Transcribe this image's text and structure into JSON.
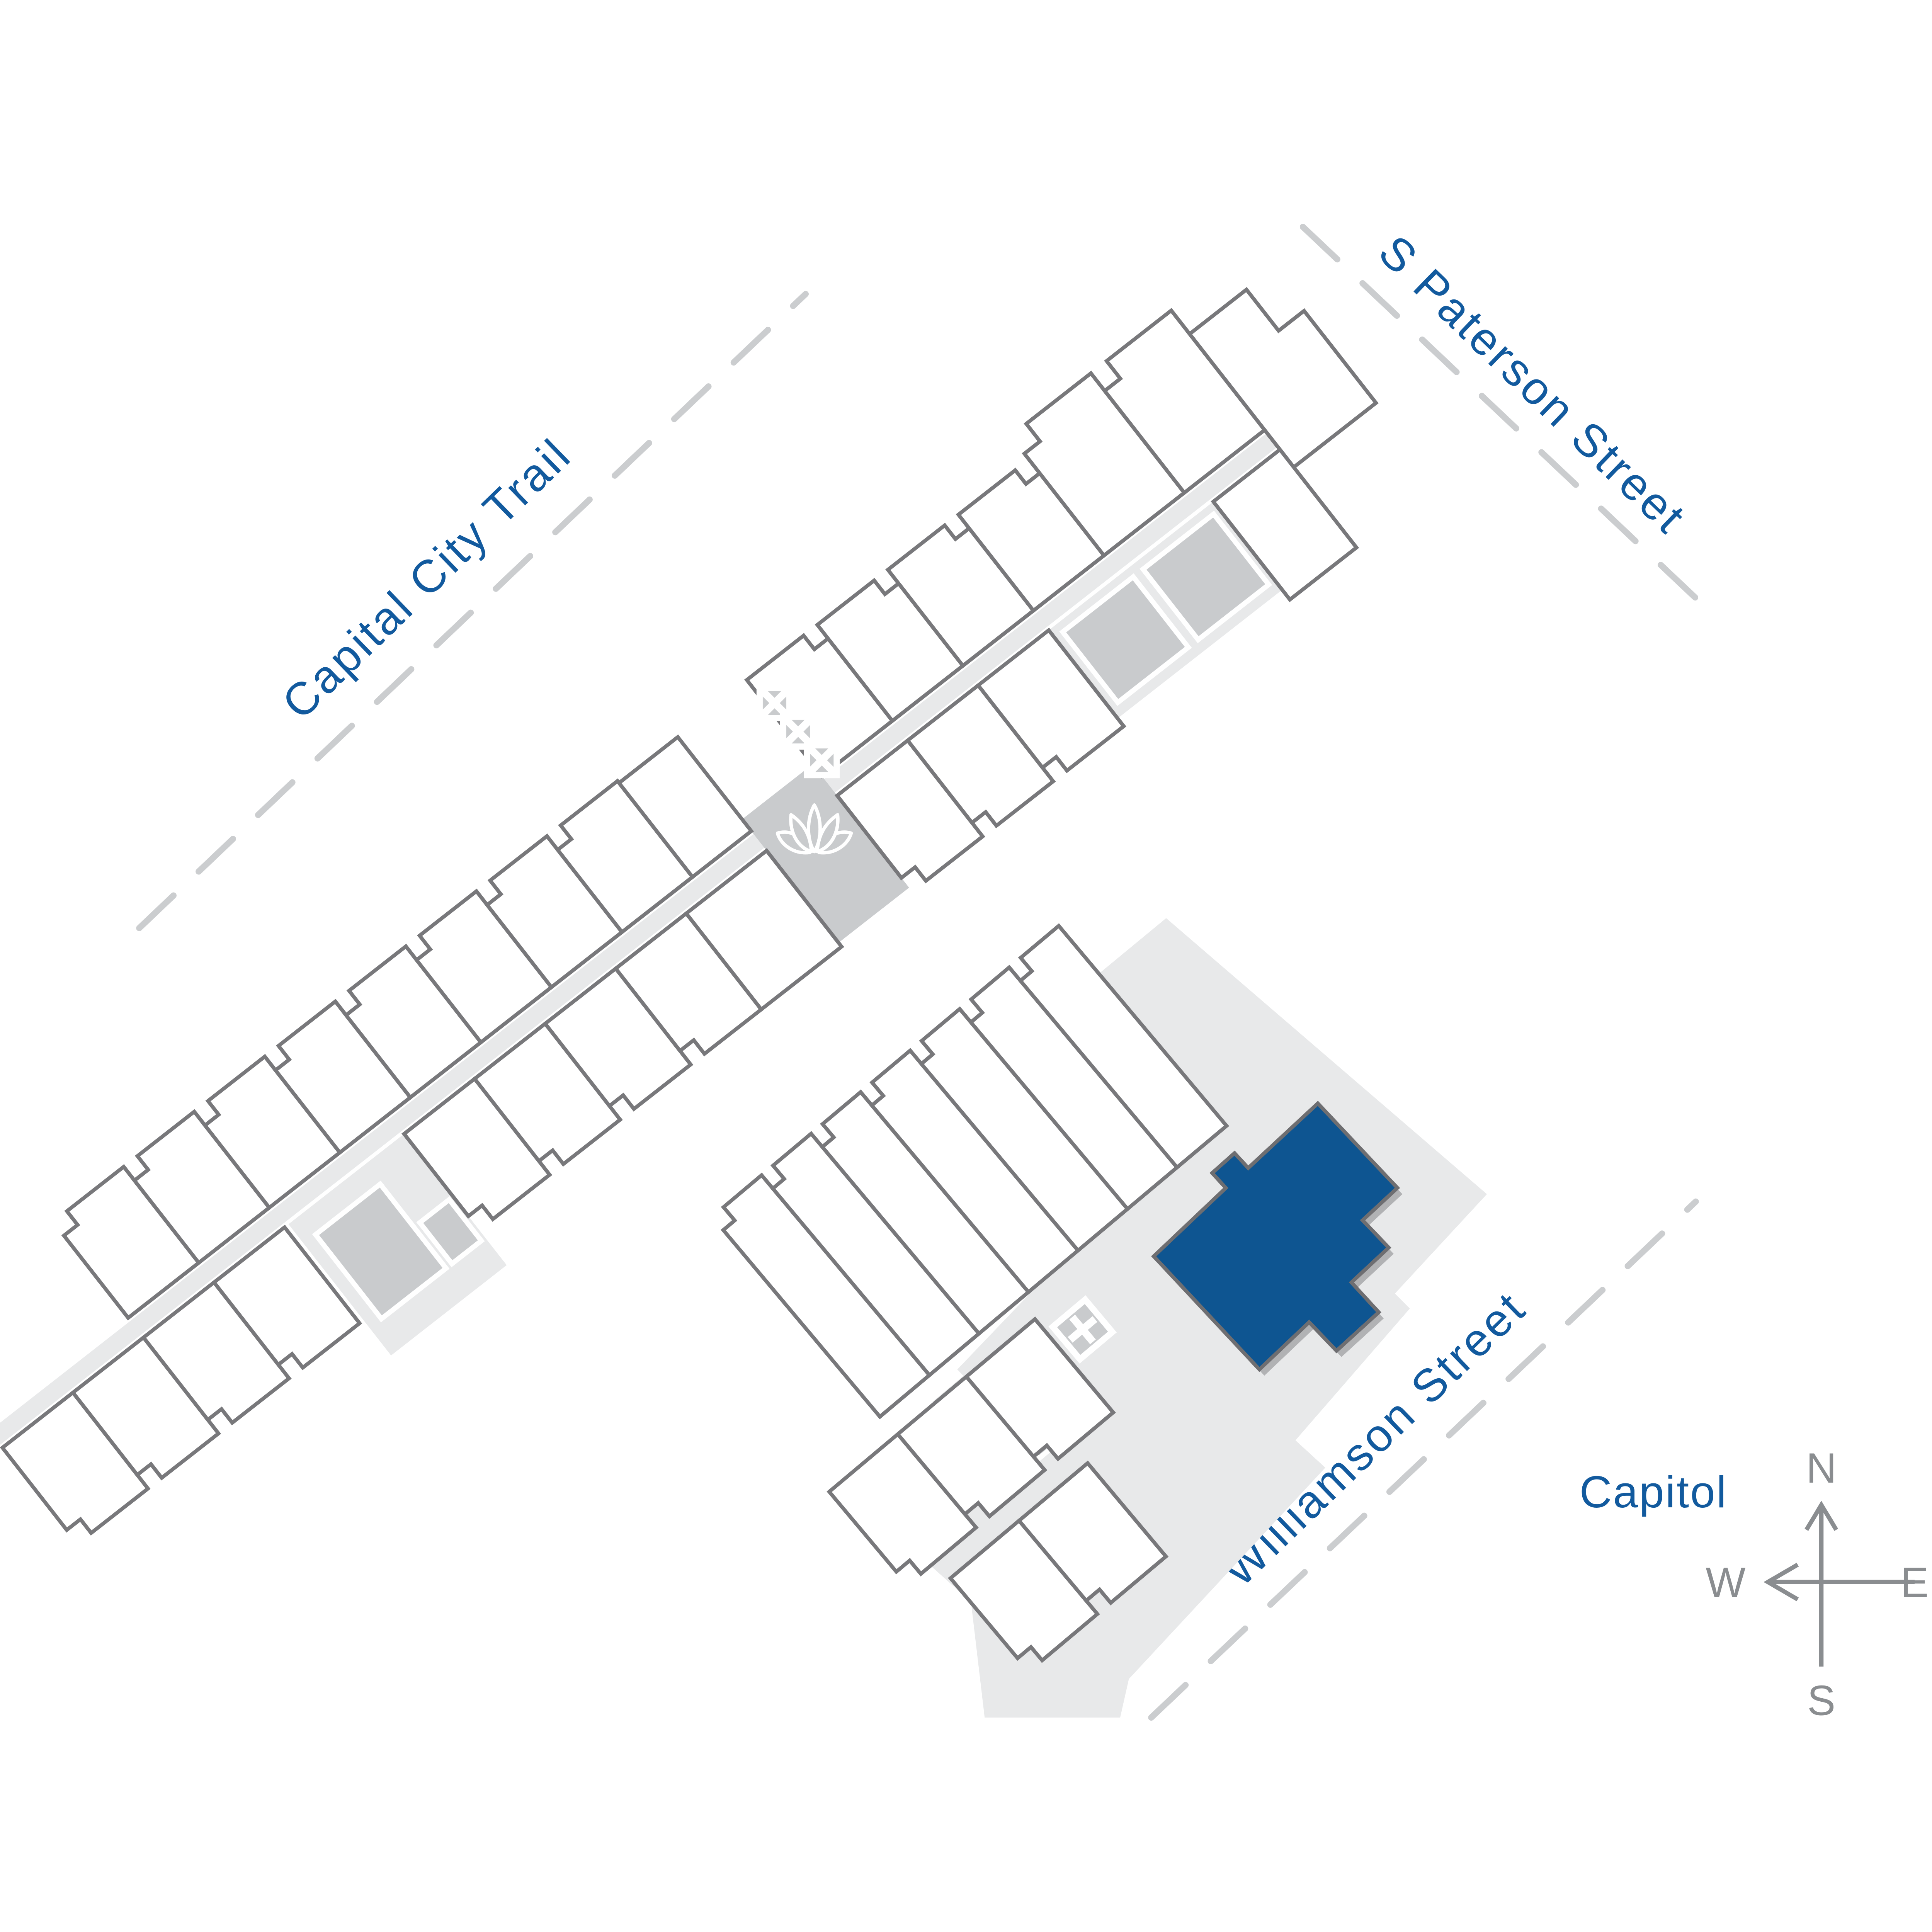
{
  "map": {
    "streets": [
      {
        "id": "capital-city-trail",
        "label": "Capital City Trail"
      },
      {
        "id": "s-paterson-street",
        "label": "S Paterson Street"
      },
      {
        "id": "williamson-street",
        "label": "Williamson Street"
      }
    ],
    "landmarks": [
      {
        "id": "capitol",
        "label": "Capitol"
      }
    ],
    "compass": {
      "n": "N",
      "e": "E",
      "s": "S",
      "w": "W"
    },
    "icons": [
      {
        "name": "lotus-icon",
        "meaning": "courtyard amenity marker"
      },
      {
        "name": "x-box-icon",
        "meaning": "stair / elevator marker"
      }
    ],
    "highlighted_unit": {
      "fill": "#0e5591"
    },
    "colors": {
      "street_label": "#125a9e",
      "unit_outline": "#78787b",
      "walkway": "#e8e9ea",
      "amenity_patch": "#c9cbcd",
      "dashed_street": "#cbcdcf",
      "compass": "#8a8d90",
      "highlight": "#0e5591"
    }
  }
}
